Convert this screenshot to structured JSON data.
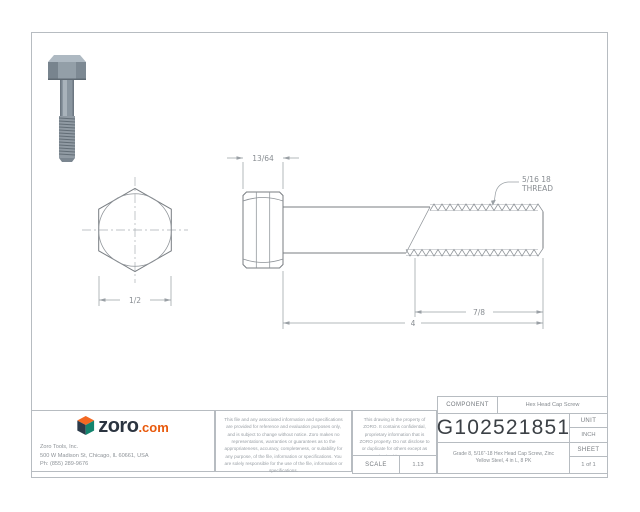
{
  "drawing": {
    "dim_head_height": "13/64",
    "thread_callout_line1": "5/16 18",
    "thread_callout_line2": "THREAD",
    "dim_across_flats": "1/2",
    "dim_thread_length": "7/8",
    "dim_overall_length": "4"
  },
  "title_block": {
    "component_label": "COMPONENT",
    "component_value": "Hex Head Cap Screw",
    "part_number": "G102521851",
    "unit_label": "UNIT",
    "unit_value": "INCH",
    "sheet_label": "SHEET",
    "sheet_value": "1 of 1",
    "scale_label": "SCALE",
    "scale_value": "1.13",
    "description": "Grade 8, 5/16\"-18 Hex Head Cap Screw, Zinc Yellow Steel, 4 in L, 8 PK"
  },
  "branding": {
    "logo_text": "zoro",
    "logo_suffix": ".com",
    "company": "Zoro Tools, Inc.",
    "address": "500 W Madison St, Chicago, IL 60661, USA",
    "phone": "Ph: (855) 289-9676"
  },
  "disclaimers": {
    "general": "This file and any associated information and specifications are provided for reference and evaluation purposes only, and is subject to change without notice. Zoro makes no representations, warranties or guarantees as to the appropriateness, accuracy, completeness, or suitability for any purpose, of the file, information or specifications. You are solely responsible for the use of the file, information or specifications.",
    "property": "This drawing is the property of ZORO. It contains confidential, proprietary information that is ZORO property. Do not disclose to or duplicate for others except as authorized by ZORO."
  },
  "colors": {
    "logo_navy": "#2b3440",
    "logo_orange": "#e8590c",
    "line_gray": "#787d82",
    "dim_gray": "#9aa0a5",
    "border_gray": "#b7bcc1"
  }
}
